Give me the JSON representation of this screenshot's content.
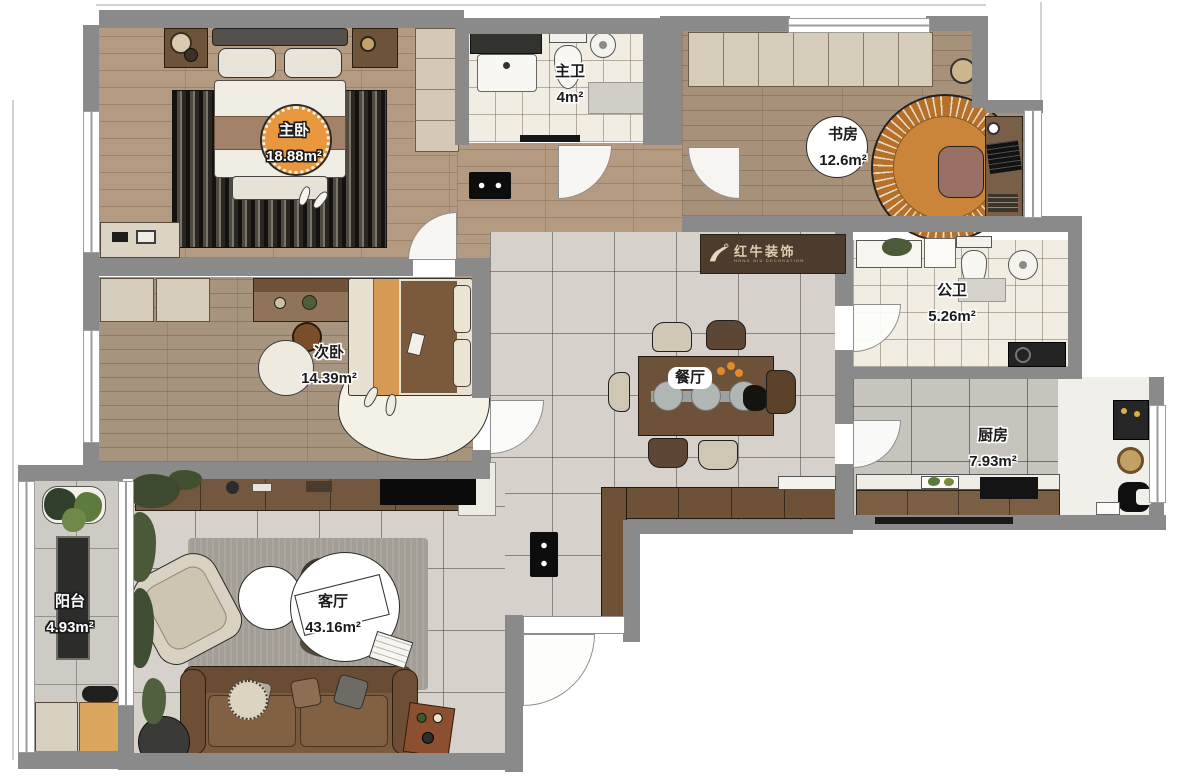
{
  "logo": {
    "brand": "红牛装饰",
    "brand_en": "HONG NIU DECORATION",
    "registered": "®"
  },
  "rooms": {
    "master_bedroom": {
      "name": "主卧",
      "area": "18.88m²"
    },
    "master_bath": {
      "name": "主卫",
      "area": "4m²"
    },
    "study": {
      "name": "书房",
      "area": "12.6m²"
    },
    "public_bath": {
      "name": "公卫",
      "area": "5.26m²"
    },
    "second_bedroom": {
      "name": "次卧",
      "area": "14.39m²"
    },
    "dining": {
      "name": "餐厅",
      "area": ""
    },
    "kitchen": {
      "name": "厨房",
      "area": "7.93m²"
    },
    "balcony": {
      "name": "阳台",
      "area": "4.93m²"
    },
    "living": {
      "name": "客厅",
      "area": "43.16m²"
    }
  },
  "colors": {
    "wall": "#8a8a8a",
    "wood": "#b49a80",
    "label_orange": "#e8973f",
    "rug_orange": "#c07430"
  }
}
